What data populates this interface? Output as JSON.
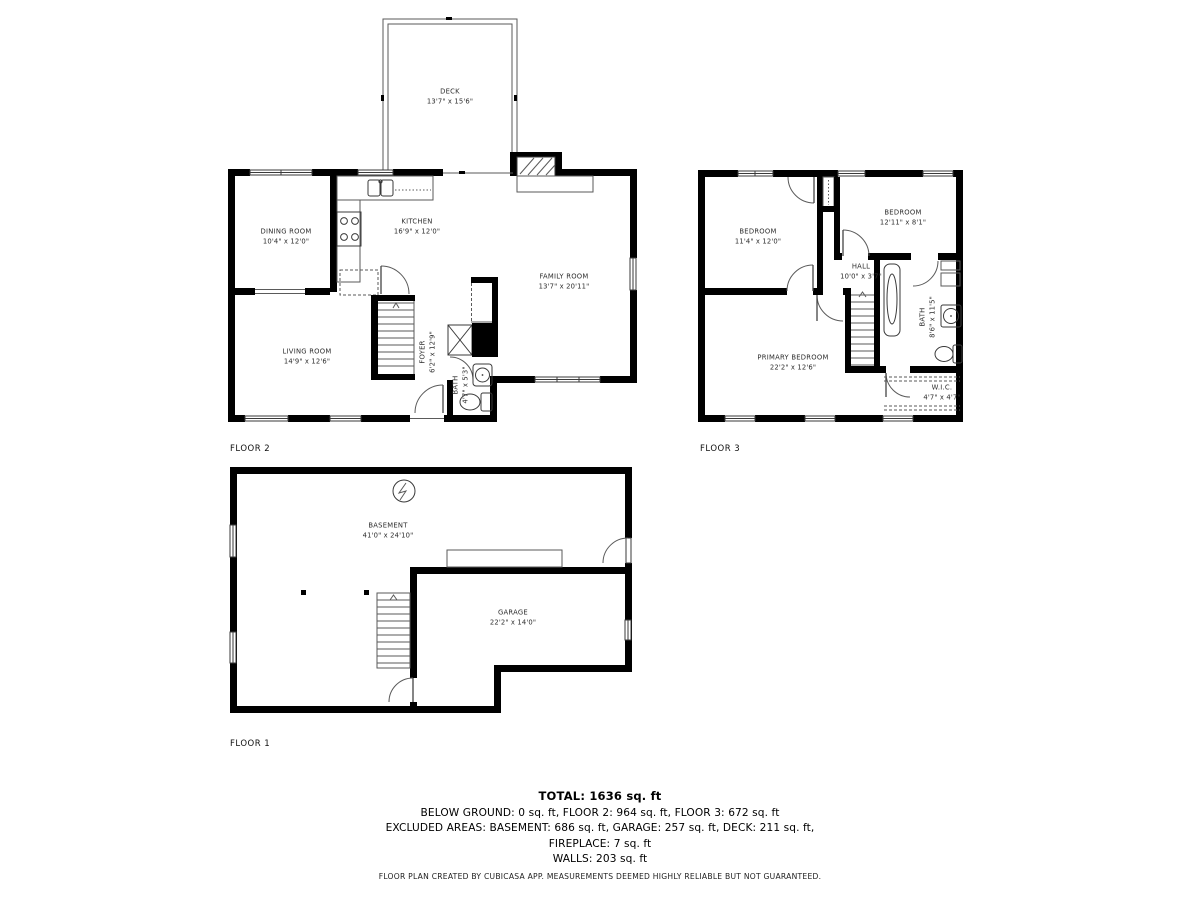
{
  "colors": {
    "wall": "#000000",
    "thin_line": "#5a5a5a",
    "background": "#ffffff"
  },
  "floors": [
    {
      "label": "FLOOR 2",
      "rooms": [
        {
          "name": "DECK",
          "dims": "13'7\" x 15'6\""
        },
        {
          "name": "DINING ROOM",
          "dims": "10'4\" x 12'0\""
        },
        {
          "name": "KITCHEN",
          "dims": "16'9\" x 12'0\""
        },
        {
          "name": "FAMILY ROOM",
          "dims": "13'7\" x 20'11\""
        },
        {
          "name": "LIVING ROOM",
          "dims": "14'9\" x 12'6\""
        },
        {
          "name": "FOYER",
          "dims": "6'2\" x 12'9\""
        },
        {
          "name": "BATH",
          "dims": "4'7\" x 5'3\""
        }
      ]
    },
    {
      "label": "FLOOR 3",
      "rooms": [
        {
          "name": "BEDROOM",
          "dims": "11'4\" x 12'0\""
        },
        {
          "name": "BEDROOM",
          "dims": "12'11\" x 8'1\""
        },
        {
          "name": "HALL",
          "dims": "10'0\" x 3'7\""
        },
        {
          "name": "PRIMARY BEDROOM",
          "dims": "22'2\" x 12'6\""
        },
        {
          "name": "BATH",
          "dims": "8'6\" x 11'5\""
        },
        {
          "name": "W.I.C.",
          "dims": "4'7\" x 4'7\""
        }
      ]
    },
    {
      "label": "FLOOR 1",
      "rooms": [
        {
          "name": "BASEMENT",
          "dims": "41'0\" x 24'10\""
        },
        {
          "name": "GARAGE",
          "dims": "22'2\" x 14'0\""
        }
      ]
    }
  ],
  "summary": {
    "total": "TOTAL: 1636 sq. ft",
    "floors_line": "BELOW GROUND: 0 sq. ft, FLOOR 2: 964 sq. ft, FLOOR 3: 672 sq. ft",
    "excluded_line": "EXCLUDED AREAS: BASEMENT: 686 sq. ft, GARAGE: 257 sq. ft, DECK: 211 sq. ft,",
    "fireplace_line": "FIREPLACE: 7 sq. ft",
    "walls_line": "WALLS: 203 sq. ft"
  },
  "footer": "FLOOR PLAN CREATED BY CUBICASA APP. MEASUREMENTS DEEMED HIGHLY RELIABLE BUT NOT GUARANTEED."
}
